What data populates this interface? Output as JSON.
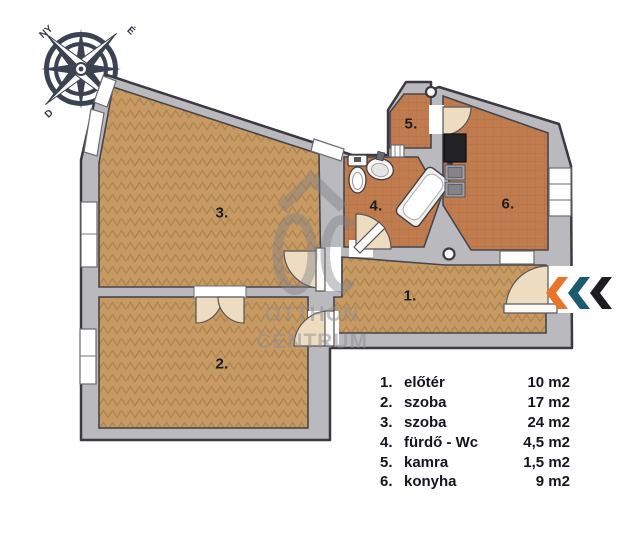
{
  "compass": {
    "north": "É",
    "west": "NY",
    "south": "D"
  },
  "watermark": {
    "line1": "OTTHON",
    "line2": "CENTRUM"
  },
  "rooms": [
    {
      "num": "1.",
      "name": "előtér",
      "area": "10 m2"
    },
    {
      "num": "2.",
      "name": "szoba",
      "area": "17 m2"
    },
    {
      "num": "3.",
      "name": "szoba",
      "area": "24 m2"
    },
    {
      "num": "4.",
      "name": "fürdő - Wc",
      "area": "4,5 m2"
    },
    {
      "num": "5.",
      "name": "kamra",
      "area": "1,5 m2"
    },
    {
      "num": "6.",
      "name": "konyha",
      "area": "9 m2"
    }
  ],
  "entrance": {
    "chevrons": [
      "#e8732a",
      "#1c5a70",
      "#1e1e22"
    ]
  },
  "colors": {
    "wall": "#b9b9be",
    "outline": "#3a3a40",
    "parquet": "#c79a63",
    "tile": "#c07c4e",
    "door_fan": "#eddcc0",
    "watermark_gray": "#8e8e93"
  }
}
